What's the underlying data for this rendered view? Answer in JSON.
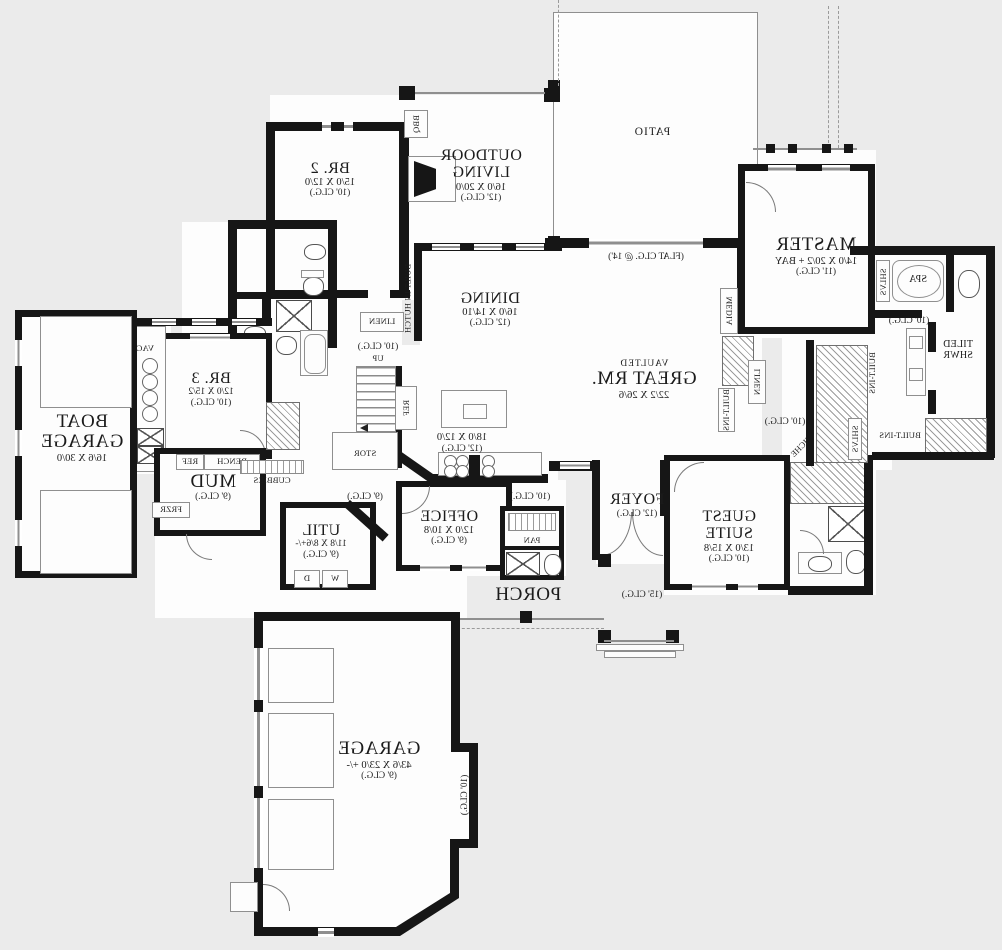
{
  "rooms": {
    "br2": {
      "name": "BR. 2",
      "dims": "15/0 X 12/0",
      "ceil": "(10' CLG.)"
    },
    "br3": {
      "name": "BR. 3",
      "dims": "12/0 X 15/2",
      "ceil": "(10' CLG.)"
    },
    "outdoor": {
      "name": "OUTDOOR",
      "name2": "LIVING",
      "dims": "16/0 X 20/0",
      "ceil": "(12' CLG.)"
    },
    "patio": {
      "name": "PATIO"
    },
    "master": {
      "name": "MASTER",
      "dims": "14/0 X 20/2 + BAY",
      "ceil": "(11' CLG.)"
    },
    "great": {
      "prefix": "VAULTED",
      "name": "GREAT RM.",
      "dims": "22/2 X 26/6",
      "flat": "(FLAT CLG. @ 14')"
    },
    "dining": {
      "name": "DINING",
      "dims": "16/0 X 14/10",
      "ceil": "(12' CLG.)"
    },
    "kitchen": {
      "dims": "18/0 X 12/0",
      "ceil": "(12' CLG.)"
    },
    "office": {
      "name": "OFFICE",
      "dims": "12/0 X 10/8",
      "ceil": "(9' CLG.)"
    },
    "foyer": {
      "name": "FOYER",
      "ceil": "(12' CLG.)"
    },
    "entry": {
      "ceil": "(15' CLG.)"
    },
    "porch": {
      "name": "PORCH"
    },
    "guest": {
      "name": "GUEST SUITE",
      "dims": "13/0 X 15/8",
      "ceil": "(10' CLG.)"
    },
    "mud": {
      "name": "MUD",
      "ceil": "(9' CLG.)"
    },
    "util": {
      "name": "UTIL",
      "dims": "11/8 X 8/6+/-",
      "ceil": "(9' CLG.)"
    },
    "garage": {
      "name": "GARAGE",
      "dims": "43/6 X 23/0 +/-",
      "ceil": "(9' CLG.)"
    },
    "boat": {
      "name": "BOAT",
      "name2": "GARAGE",
      "dims": "16/6 X 30/0"
    }
  },
  "fixtures": {
    "bbq": "BBQ",
    "spa": "SPA",
    "tiled_shwr": "TILED",
    "tiled_shwr2": "SHWR",
    "vacuum": "VACUUM",
    "ref": "REF",
    "frzr": "FRZR",
    "bench": "BENCH",
    "cubbies": "CUBBIES",
    "stor": "STOR",
    "up": "UP",
    "pan": "PAN",
    "linen": "LINEN",
    "media": "MEDIA",
    "niche": "NICHE",
    "shlvs": "SHLVS",
    "built_ins": "BUILT-INS",
    "built_in_hutch": "BUILT-IN HUTCH",
    "washer": "W",
    "dryer": "D"
  },
  "ceilings": {
    "c9": "(9' CLG.)",
    "c10": "(10' CLG.)",
    "c15": "(15' CLG.)"
  },
  "colors": {
    "wall": "#161616",
    "background": "#ebebeb",
    "floor": "#fdfdfd",
    "thin_line": "#8f8f8f"
  }
}
